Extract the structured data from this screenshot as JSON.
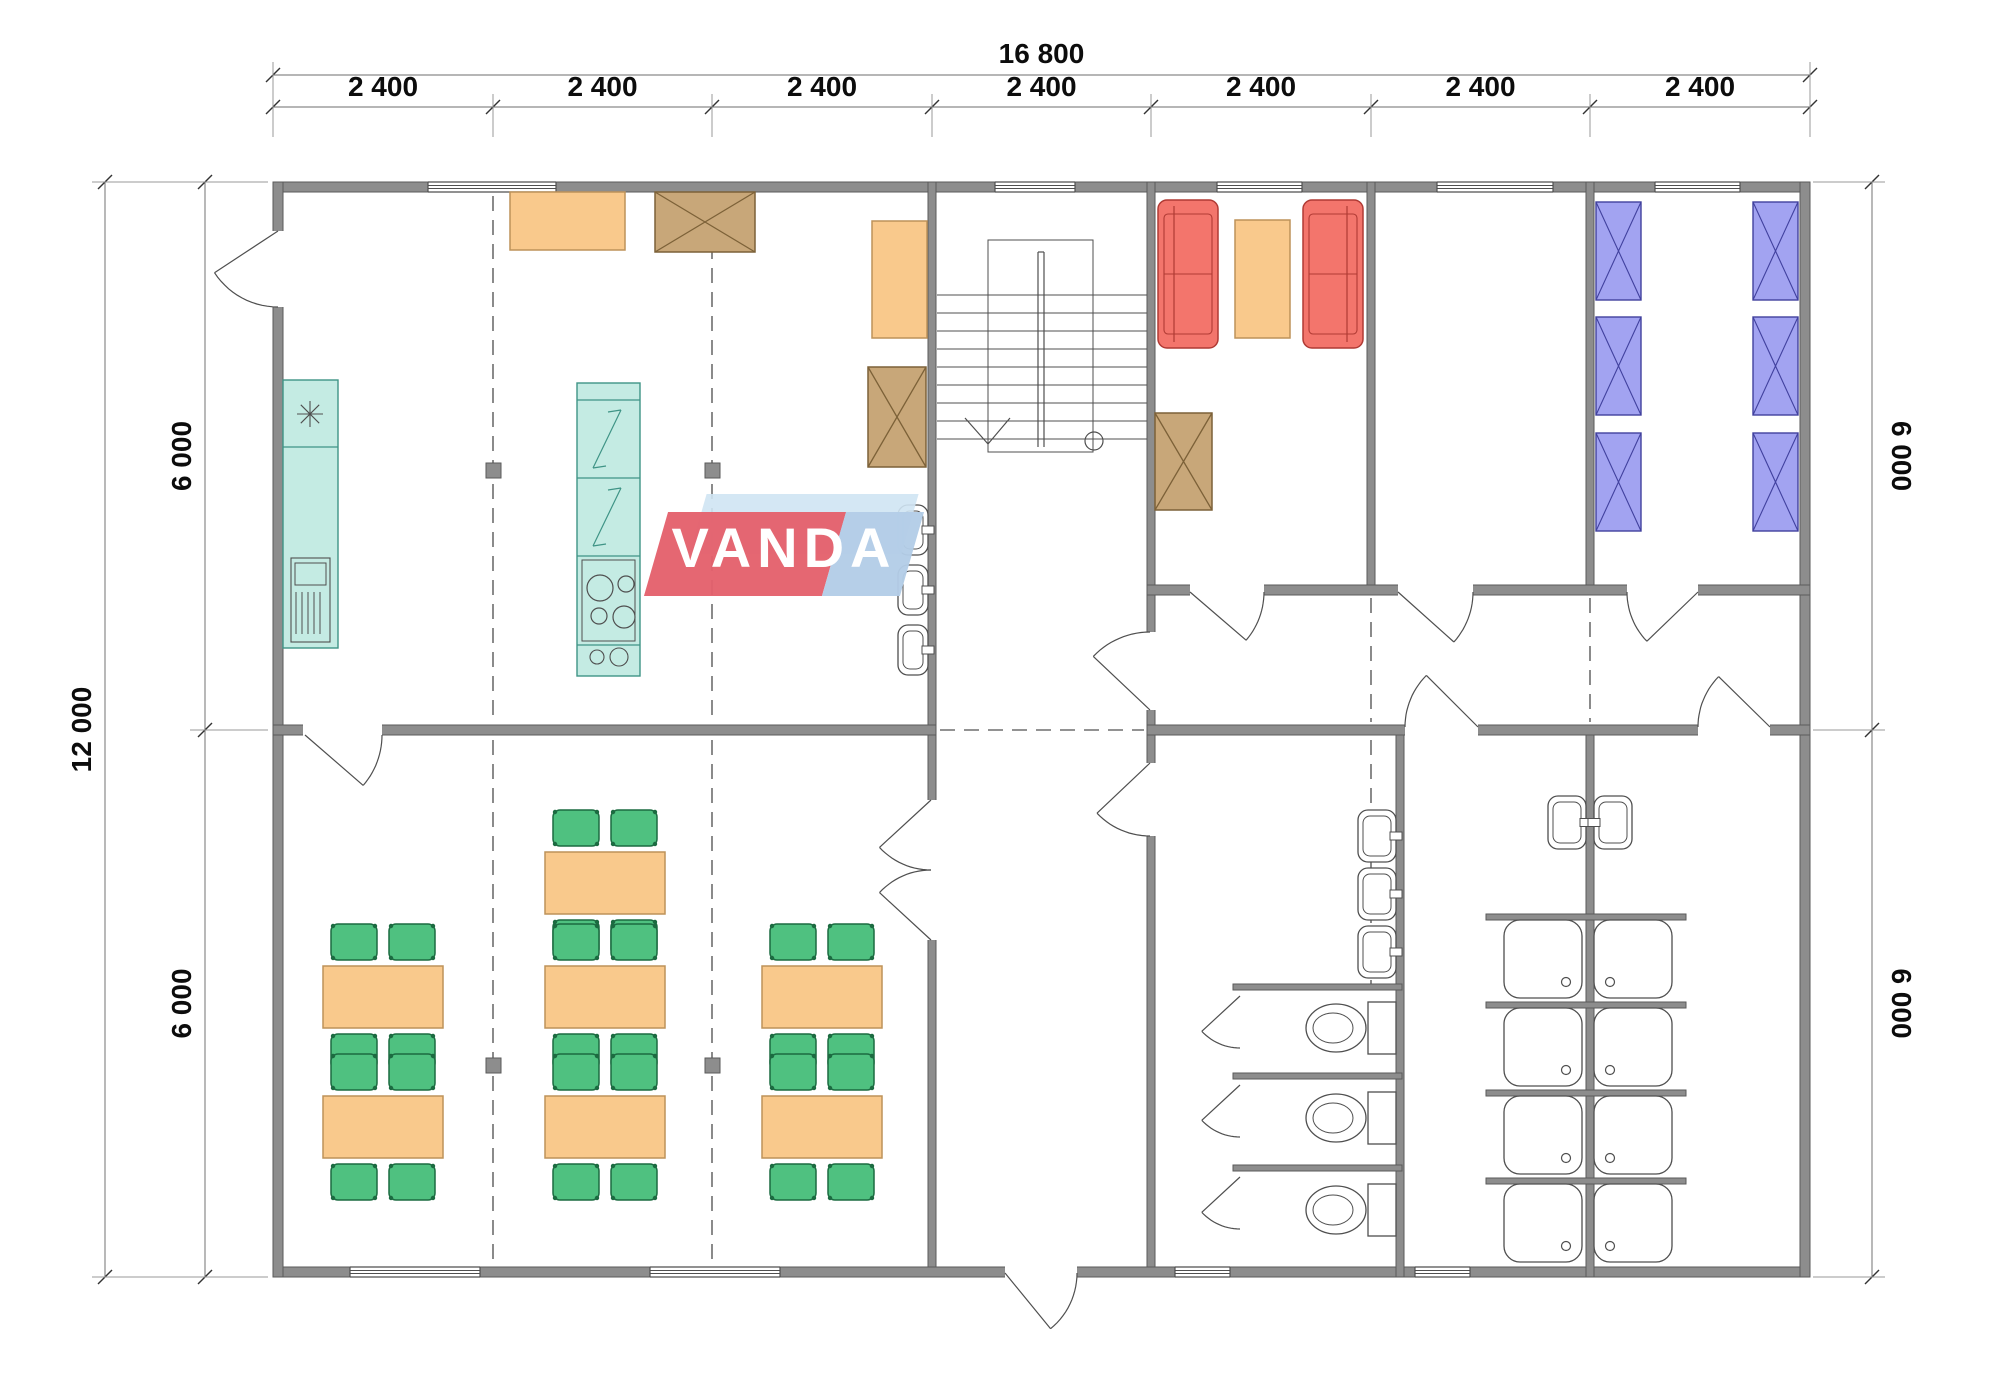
{
  "logo": {
    "text": "VANDA"
  },
  "dimensions": {
    "overall_width": "16 800",
    "segments": [
      "2 400",
      "2 400",
      "2 400",
      "2 400",
      "2 400",
      "2 400",
      "2 400"
    ],
    "overall_height": "12 000",
    "left_halves": [
      "6 000",
      "6 000"
    ],
    "right_halves": [
      "6 000",
      "6 000"
    ]
  },
  "colors": {
    "wall": "#8d8d8d",
    "wall_edge": "#5a5a5a",
    "line": "#4f4f4f",
    "grid": "#6e6e6e",
    "dim": "#8a8a8a",
    "dim_text": "#0c0c0c",
    "teal": "#c4ebe3",
    "teal_edge": "#3f9486",
    "orange": "#f9c98c",
    "orange_edge": "#bd9259",
    "brown": "#c8a779",
    "brown_edge": "#7c6138",
    "green": "#4fc180",
    "green_edge": "#1c6b41",
    "red": "#f3756c",
    "red_edge": "#b03a34",
    "blue": "#a2a3f1",
    "blue_edge": "#41419e",
    "logo_red": "#e4616c",
    "logo_blue_light": "#cfe4f3",
    "logo_blue": "#b3cde7",
    "logo_text": "#ffffff"
  },
  "plan": {
    "grid_cols": [
      273,
      493,
      712,
      932,
      1151,
      1371,
      1590,
      1810
    ],
    "grid_dashes": [
      [
        493,
        196,
        493,
        720
      ],
      [
        493,
        740,
        493,
        1262
      ],
      [
        712,
        196,
        712,
        720
      ],
      [
        712,
        740,
        712,
        1262
      ],
      [
        1371,
        598,
        1371,
        722
      ],
      [
        1371,
        740,
        1371,
        984
      ],
      [
        1590,
        598,
        1590,
        722
      ],
      [
        940,
        730,
        1144,
        730
      ]
    ],
    "walls": [
      [
        273,
        182,
        1537,
        10
      ],
      [
        273,
        1267,
        1537,
        10
      ],
      [
        273,
        182,
        10,
        1095
      ],
      [
        1800,
        182,
        10,
        1095
      ],
      [
        928,
        182,
        8,
        1085
      ],
      [
        1147,
        182,
        8,
        1085
      ],
      [
        1367,
        182,
        8,
        413
      ],
      [
        1586,
        182,
        8,
        413
      ],
      [
        1586,
        725,
        8,
        552
      ],
      [
        1396,
        725,
        8,
        552
      ],
      [
        273,
        725,
        663,
        10
      ],
      [
        1147,
        585,
        663,
        10
      ],
      [
        1147,
        725,
        663,
        10
      ],
      [
        1233,
        984,
        169,
        6
      ],
      [
        1233,
        1073,
        169,
        6
      ],
      [
        1233,
        1165,
        169,
        6
      ],
      [
        1486,
        914,
        200,
        6
      ],
      [
        1486,
        1002,
        200,
        6
      ],
      [
        1486,
        1090,
        200,
        6
      ],
      [
        1486,
        1178,
        200,
        6
      ]
    ],
    "openings": [
      [
        270,
        231,
        14,
        76
      ],
      [
        303,
        723,
        79,
        14
      ],
      [
        925,
        800,
        13,
        140
      ],
      [
        1005,
        1265,
        72,
        14
      ],
      [
        1144,
        632,
        13,
        78
      ],
      [
        1144,
        763,
        13,
        73
      ],
      [
        1190,
        583,
        74,
        14
      ],
      [
        1398,
        583,
        75,
        14
      ],
      [
        1627,
        583,
        71,
        14
      ],
      [
        1405,
        723,
        73,
        14
      ],
      [
        1698,
        723,
        72,
        14
      ]
    ],
    "windows": [
      [
        428,
        182,
        128
      ],
      [
        995,
        182,
        80
      ],
      [
        1217,
        182,
        85
      ],
      [
        1437,
        182,
        116
      ],
      [
        1655,
        182,
        85
      ],
      [
        350,
        1267,
        130
      ],
      [
        650,
        1267,
        130
      ],
      [
        1175,
        1267,
        55
      ],
      [
        1415,
        1267,
        55
      ]
    ],
    "doors": [
      {
        "h": [
          278,
          231
        ],
        "t": [
          214,
          273
        ],
        "e": [
          278,
          307
        ]
      },
      {
        "h": [
          305,
          735
        ],
        "t": [
          365,
          787
        ],
        "e": [
          382,
          735
        ]
      },
      {
        "h": [
          931,
          800
        ],
        "t": [
          868,
          858
        ],
        "e": [
          931,
          870
        ]
      },
      {
        "h": [
          931,
          940
        ],
        "t": [
          868,
          882
        ],
        "e": [
          931,
          870
        ]
      },
      {
        "h": [
          1005,
          1273
        ],
        "t": [
          1050,
          1328
        ],
        "e": [
          1077,
          1273
        ]
      },
      {
        "h": [
          1150,
          763
        ],
        "t": [
          1092,
          818
        ],
        "e": [
          1150,
          836
        ]
      },
      {
        "h": [
          1150,
          710
        ],
        "t": [
          1094,
          657
        ],
        "e": [
          1150,
          632
        ]
      },
      {
        "h": [
          1190,
          592
        ],
        "t": [
          1247,
          641
        ],
        "e": [
          1264,
          592
        ]
      },
      {
        "h": [
          1398,
          592
        ],
        "t": [
          1454,
          642
        ],
        "e": [
          1473,
          592
        ]
      },
      {
        "h": [
          1698,
          592
        ],
        "t": [
          1644,
          644
        ],
        "e": [
          1627,
          592
        ]
      },
      {
        "h": [
          1478,
          727
        ],
        "t": [
          1424,
          673
        ],
        "e": [
          1405,
          727
        ]
      },
      {
        "h": [
          1770,
          727
        ],
        "t": [
          1716,
          674
        ],
        "e": [
          1698,
          727
        ]
      },
      {
        "h": [
          1240,
          996
        ],
        "t": [
          1188,
          1044
        ],
        "e": [
          1240,
          1048
        ]
      },
      {
        "h": [
          1240,
          1085
        ],
        "t": [
          1188,
          1133
        ],
        "e": [
          1240,
          1137
        ]
      },
      {
        "h": [
          1240,
          1177
        ],
        "t": [
          1188,
          1225
        ],
        "e": [
          1240,
          1229
        ]
      }
    ],
    "stairs": {
      "x1": 937,
      "x2": 1147,
      "outline": [
        988,
        240,
        105,
        212
      ],
      "tread_y1": 295,
      "tread_y2": 439,
      "treads": 9,
      "mid_x": 1041,
      "walk_x": 988,
      "arrow": [
        965,
        1010,
        418,
        444
      ],
      "circle": [
        1094,
        441,
        9
      ]
    },
    "tables": [
      [
        545,
        852
      ],
      [
        323,
        966
      ],
      [
        545,
        966
      ],
      [
        762,
        966
      ],
      [
        323,
        1096
      ],
      [
        545,
        1096
      ],
      [
        762,
        1096
      ]
    ],
    "table_size": [
      120,
      62
    ],
    "chair_size": [
      46,
      36
    ],
    "orange_boxes": [
      [
        510,
        192,
        115,
        58
      ],
      [
        872,
        221,
        55,
        117
      ],
      [
        1235,
        220,
        55,
        118
      ]
    ],
    "crossed_boxes": [
      [
        655,
        192,
        100,
        60
      ],
      [
        868,
        367,
        58,
        100
      ],
      [
        1155,
        413,
        57,
        97
      ]
    ],
    "sofas": [
      {
        "x": 1158,
        "y": 200,
        "back": "l"
      },
      {
        "x": 1303,
        "y": 200,
        "back": "r"
      }
    ],
    "sofa_size": [
      60,
      148
    ],
    "beds": [
      [
        1596,
        202
      ],
      [
        1596,
        317
      ],
      [
        1596,
        433
      ],
      [
        1753,
        202
      ],
      [
        1753,
        317
      ],
      [
        1753,
        433
      ]
    ],
    "bed_size": [
      45,
      98
    ],
    "basins": [
      {
        "x": 898,
        "y": 505,
        "w": 30,
        "h": 50,
        "tap": "r"
      },
      {
        "x": 898,
        "y": 565,
        "w": 30,
        "h": 50,
        "tap": "r"
      },
      {
        "x": 898,
        "y": 625,
        "w": 30,
        "h": 50,
        "tap": "r"
      },
      {
        "x": 1358,
        "y": 810,
        "w": 38,
        "h": 52,
        "tap": "r"
      },
      {
        "x": 1358,
        "y": 868,
        "w": 38,
        "h": 52,
        "tap": "r"
      },
      {
        "x": 1358,
        "y": 926,
        "w": 38,
        "h": 52,
        "tap": "r"
      },
      {
        "x": 1548,
        "y": 796,
        "w": 38,
        "h": 53,
        "tap": "r"
      },
      {
        "x": 1594,
        "y": 796,
        "w": 38,
        "h": 53,
        "tap": "l"
      }
    ],
    "toilets": [
      1028,
      1118,
      1210
    ],
    "showers": [
      [
        1504,
        920
      ],
      [
        1594,
        920
      ],
      [
        1504,
        1008
      ],
      [
        1594,
        1008
      ],
      [
        1504,
        1096
      ],
      [
        1594,
        1096
      ],
      [
        1504,
        1184
      ],
      [
        1594,
        1184
      ]
    ],
    "shower_size": 78,
    "columns": [
      [
        486,
        463
      ],
      [
        705,
        463
      ],
      [
        486,
        1058
      ],
      [
        705,
        1058
      ]
    ],
    "kitchen_counter": {
      "x": 283,
      "y": 380,
      "w": 55,
      "h": 268,
      "divider_y": 447,
      "sink": [
        310,
        414
      ],
      "dw": [
        291,
        558,
        39,
        84
      ]
    },
    "fridge_unit": {
      "x": 577,
      "y": 383,
      "w": 63,
      "h": 293,
      "dividers": [
        400,
        478,
        556,
        645
      ],
      "bolt_sections": [
        [
          400,
          478
        ],
        [
          478,
          556
        ]
      ],
      "burners": [
        [
          600,
          588,
          13
        ],
        [
          626,
          584,
          8
        ],
        [
          599,
          616,
          8
        ],
        [
          624,
          617,
          11
        ]
      ],
      "knobs": [
        [
          597,
          657,
          7
        ],
        [
          619,
          657,
          9
        ]
      ]
    },
    "dims": {
      "top1_y": 75,
      "top2_y": 107,
      "left1_x": 105,
      "left2_x": 205,
      "right_x": 1872,
      "y_top": 182,
      "y_mid": 730,
      "y_bot": 1277
    }
  }
}
